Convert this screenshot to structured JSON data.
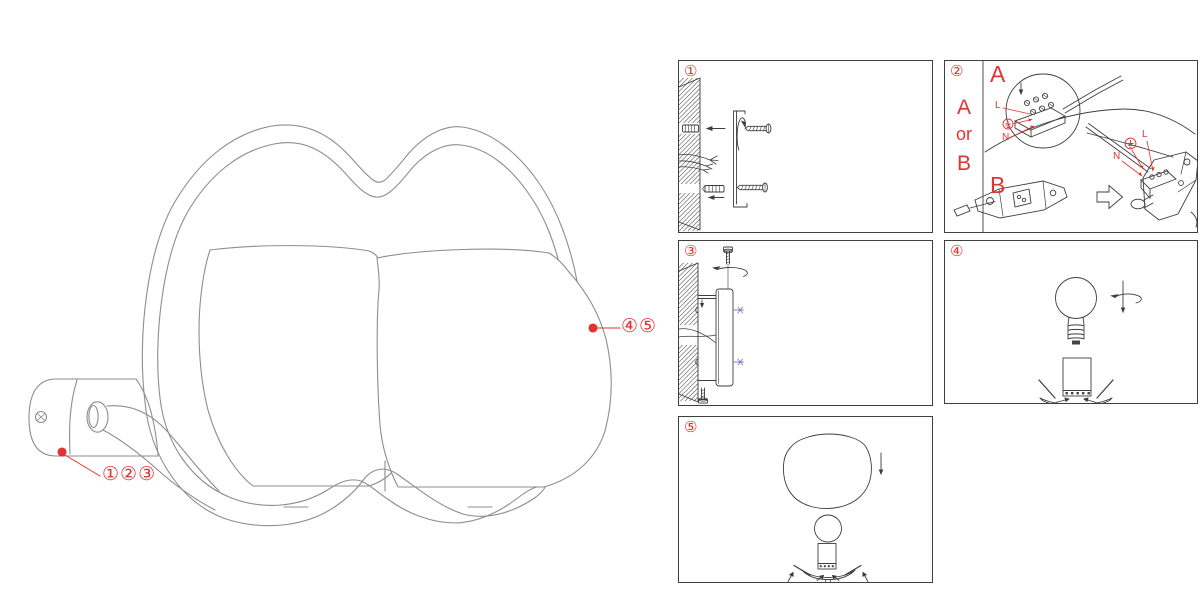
{
  "colors": {
    "accent_red": "#e23333",
    "main_line_gray": "#8d8d8d",
    "panel_line": "#3d3d3d",
    "blue_accent": "#7b7bd6"
  },
  "main_figure": {
    "callout_mount": "①②③",
    "callout_shade": "④⑤"
  },
  "panels": [
    {
      "number": "①"
    },
    {
      "number": "②",
      "side_option_top": "A",
      "side_option_mid": "or",
      "side_option_bottom": "B",
      "section_a_label": "A",
      "section_b_label": "B",
      "terminal_live": "L",
      "terminal_neutral": "N",
      "fixture_live": "L",
      "fixture_neutral": "N"
    },
    {
      "number": "③"
    },
    {
      "number": "④"
    },
    {
      "number": "⑤"
    }
  ]
}
